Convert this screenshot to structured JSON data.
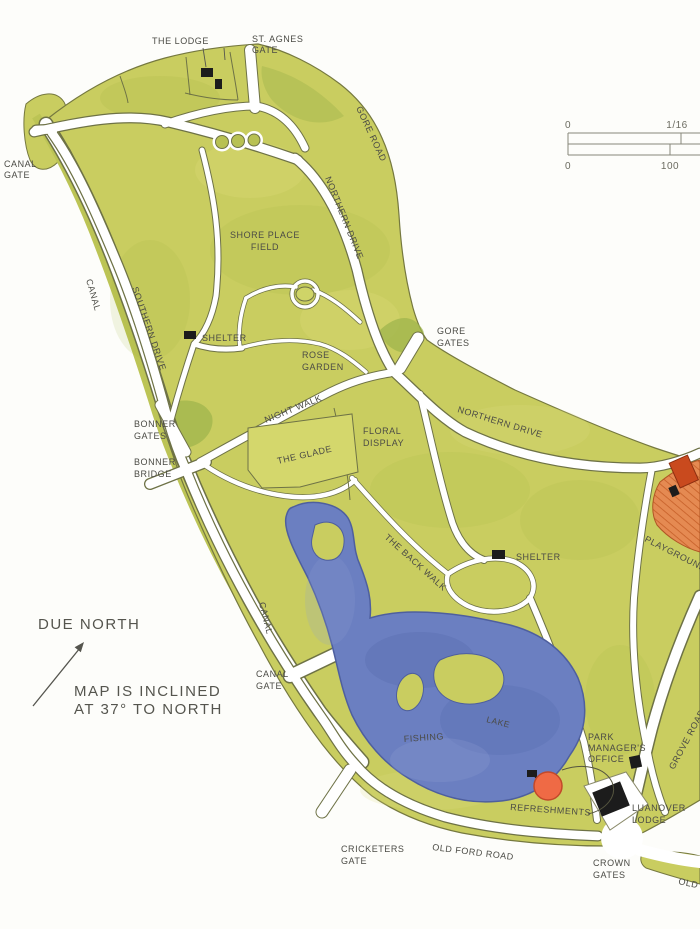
{
  "map": {
    "region_labels": {
      "the_lodge": "THE LODGE",
      "st_agnes_gate": [
        "ST. AGNES",
        "GATE"
      ],
      "canal_gate_upper": [
        "CANAL",
        "GATE"
      ],
      "gore_road": "GORE ROAD",
      "northern_drive_upper": "NORTHERN DRIVE",
      "shore_place_field": [
        "SHORE PLACE",
        "FIELD"
      ],
      "canal_upper": "CANAL",
      "southern_drive": "SOUTHERN DRIVE",
      "shelter_west": "SHELTER",
      "rose_garden": [
        "ROSE",
        "GARDEN"
      ],
      "gore_gates": [
        "GORE",
        "GATES"
      ],
      "northern_drive_lower": "NORTHERN DRIVE",
      "night_walk": "NIGHT WALK",
      "the_glade": "THE GLADE",
      "floral_display": [
        "FLORAL",
        "DISPLAY"
      ],
      "bonner_gates": [
        "BONNER",
        "GATES"
      ],
      "bonner_bridge": [
        "BONNER",
        "BRIDGE"
      ],
      "the_back_walk": "THE BACK WALK",
      "shelter_east": "SHELTER",
      "playground": "PLAYGROUND",
      "canal_lower": "CANAL",
      "canal_gate_lower": [
        "CANAL",
        "GATE"
      ],
      "lake": "LAKE",
      "fishing": "FISHING",
      "grove_road": "GROVE ROAD",
      "park_managers_office": [
        "PARK",
        "MANAGER'S",
        "OFFICE"
      ],
      "refreshments": "REFRESHMENTS",
      "luanover_lodge": [
        "LUANOVER",
        "LODGE"
      ],
      "crown_gates": [
        "CROWN",
        "GATES"
      ],
      "old_ford_road": "OLD FORD ROAD",
      "old_ford_road_east": "OLD",
      "cricketers_gate": [
        "CRICKETERS",
        "GATE"
      ]
    },
    "compass": {
      "due_north": "DUE NORTH",
      "note": [
        "MAP IS INCLINED",
        "AT 37° TO NORTH"
      ]
    },
    "scale_bar": {
      "miles_start": "0",
      "miles_end": "1/16",
      "yards_start": "0",
      "yards_end": "100"
    },
    "colors": {
      "park_green": "#c9cd60",
      "park_green_dark": "#9db44c",
      "lake_blue": "#6b7fc1",
      "playground_orange": "#e58a52",
      "refreshments_red": "#ef6a45",
      "building_black": "#1c1c1c",
      "path_casing": "#6e7246",
      "label_ink": "#4b4b45"
    }
  }
}
